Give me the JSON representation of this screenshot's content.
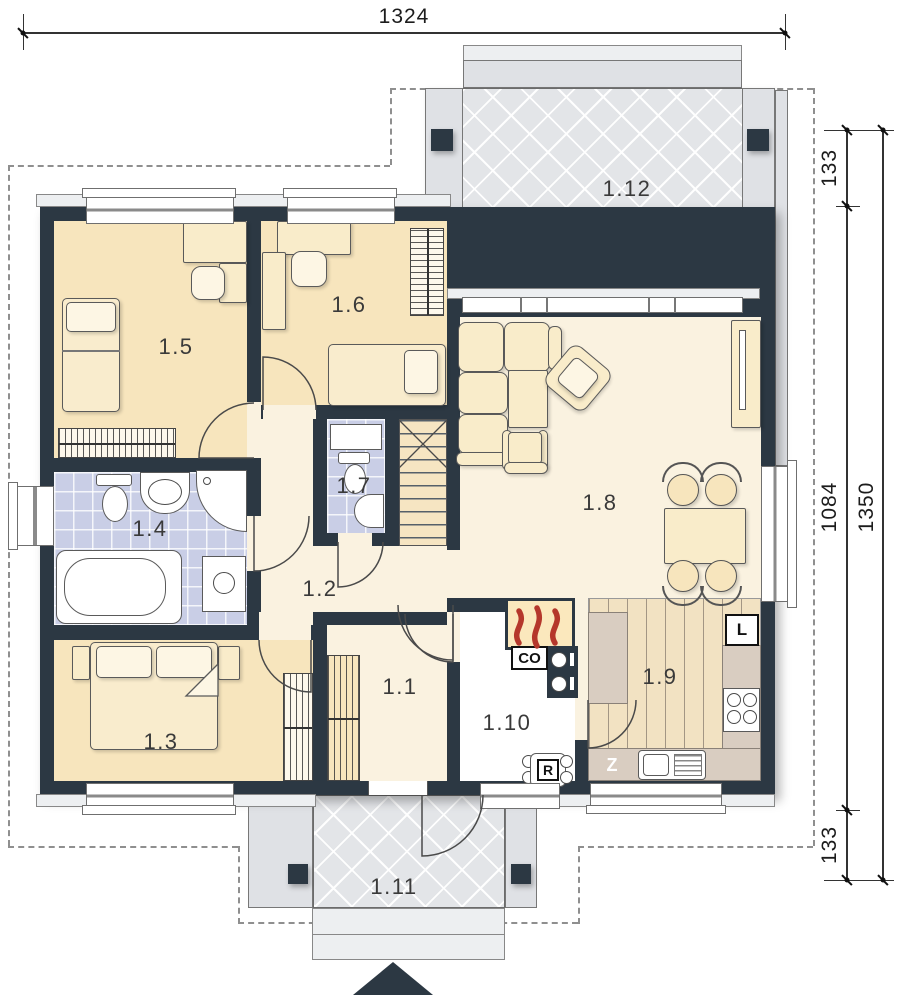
{
  "rooms": {
    "r1_1": "1.1",
    "r1_2": "1.2",
    "r1_3": "1.3",
    "r1_4": "1.4",
    "r1_5": "1.5",
    "r1_6": "1.6",
    "r1_7": "1.7",
    "r1_8": "1.8",
    "r1_9": "1.9",
    "r1_10": "1.10",
    "r1_11": "1.11",
    "r1_12": "1.12"
  },
  "dimensions": {
    "total_width": "1324",
    "terrace_depth": "133",
    "house_depth": "1084",
    "porch_depth": "133",
    "total_depth": "1350"
  },
  "equipment": {
    "boiler": "CO",
    "fridge": "L",
    "sink": "Z",
    "distributor": "R"
  },
  "colors": {
    "wall": "#2c3843",
    "bedroom_floor": "#f7e5bd",
    "hall_floor": "#faf2e0",
    "bathroom_tile": "#c9cee6",
    "terrace_gray": "#e3e5e8",
    "kitchen_counter": "#d9cdc1",
    "flame_red": "#b5372b"
  }
}
